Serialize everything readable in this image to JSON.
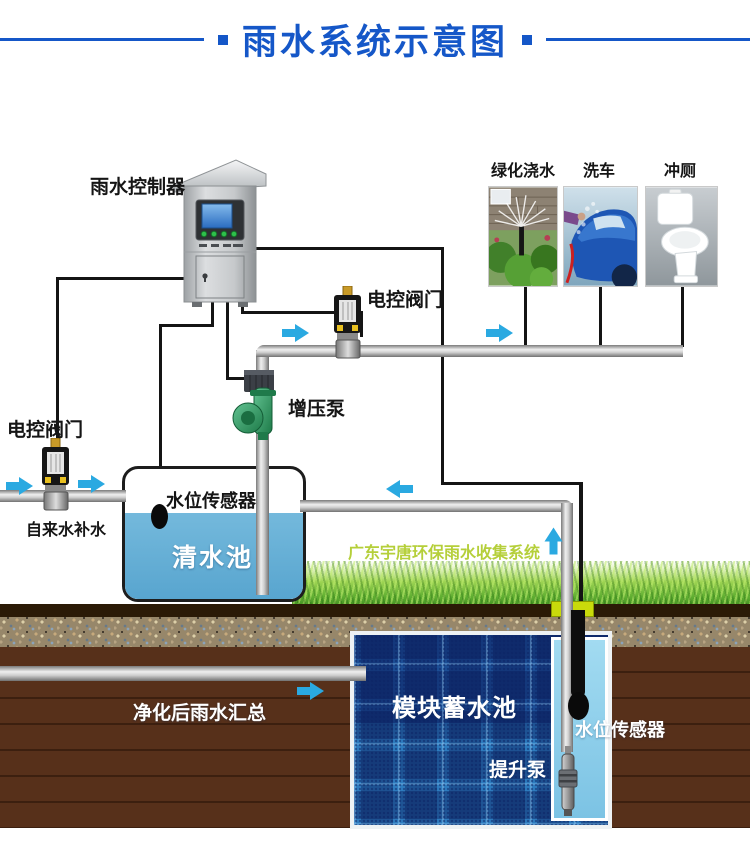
{
  "title": {
    "text": "雨水系统示意图"
  },
  "labels": {
    "controller": "雨水控制器",
    "valve_top": "电控阀门",
    "valve_left": "电控阀门",
    "booster_pump": "增压泵",
    "level_sensor_tank": "水位传感器",
    "clear_tank": "清水池",
    "tap_water": "自来水补水",
    "brand": "广东宇唐环保雨水收集系统",
    "collected_note": "净化后雨水汇总",
    "module_tank": "模块蓄水池",
    "lift_pump": "提升泵",
    "level_sensor_module": "水位传感器"
  },
  "usages": [
    {
      "label": "绿化浇水"
    },
    {
      "label": "洗车"
    },
    {
      "label": "冲厕"
    }
  ],
  "colors": {
    "title_blue": "#1557c8",
    "arrow_blue": "#2aa9e1",
    "water_blue": "#5fa9d2",
    "brand_green": "#b5cf3a",
    "pump_green": "#2f9960",
    "soil_brown": "#57301a"
  }
}
